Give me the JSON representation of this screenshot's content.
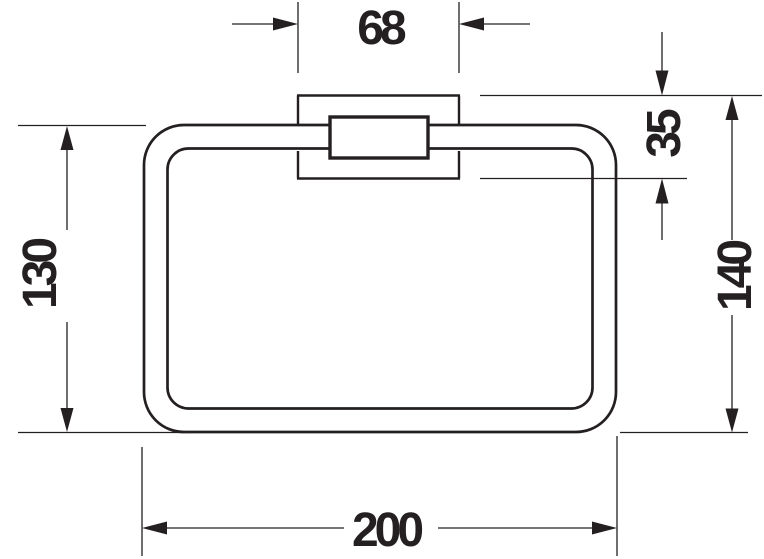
{
  "drawing": {
    "type": "technical-dimension-drawing",
    "subject": "towel ring with square wall mount bracket",
    "colors": {
      "line": "#242021",
      "background": "#ffffff"
    },
    "dimensions": {
      "mount_width": "68",
      "mount_height": "35",
      "ring_height": "130",
      "overall_height": "140",
      "ring_width": "200"
    }
  }
}
